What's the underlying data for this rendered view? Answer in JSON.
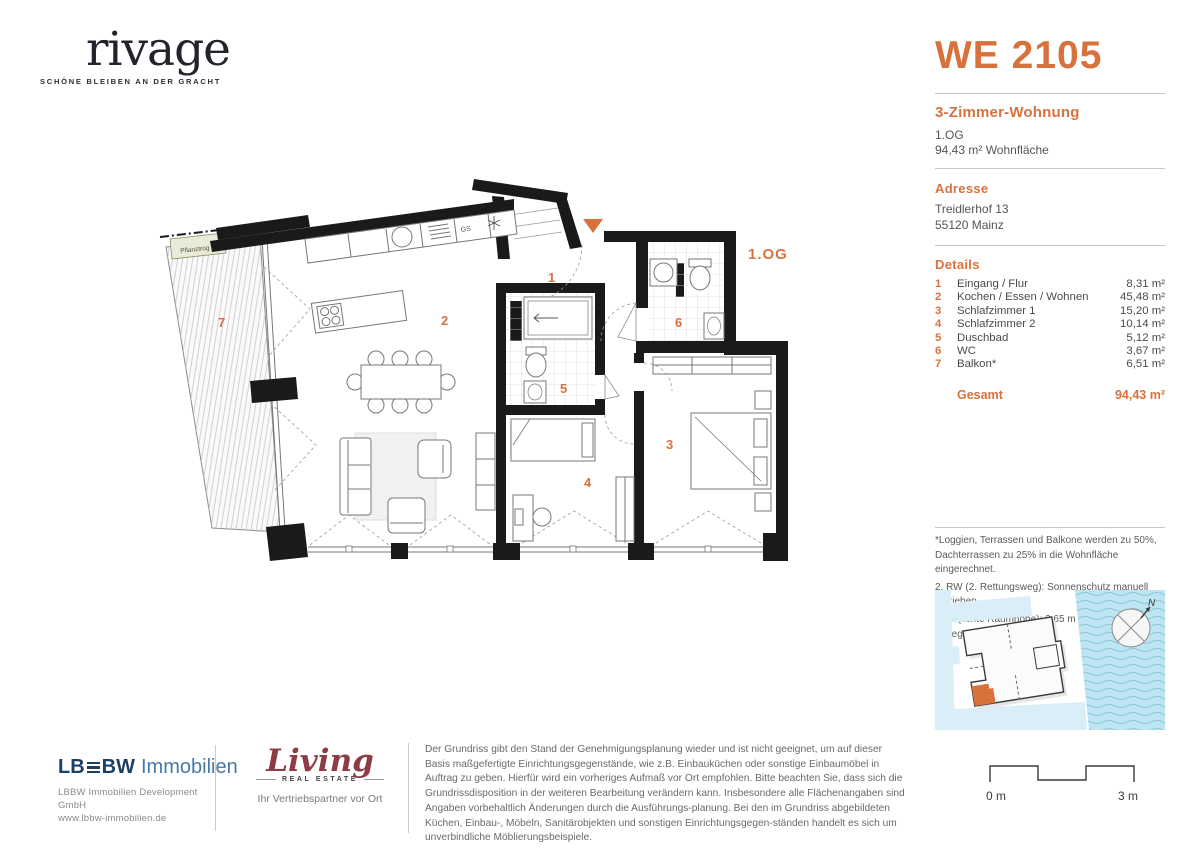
{
  "colors": {
    "accent": "#d9713c",
    "wall": "#1a1a1a",
    "lbbw_dark": "#1d3f63",
    "lbbw_light": "#4679ab",
    "living_red": "#8d3c45",
    "water": "#bfe4f1"
  },
  "brand": {
    "name": "rivage",
    "tagline": "SCHÖNE BLEIBEN AN DER GRACHT"
  },
  "unit": {
    "id": "WE 2105",
    "type": "3-Zimmer-Wohnung",
    "floor": "1.OG",
    "area_line": "94,43 m² Wohnfläche"
  },
  "address": {
    "heading": "Adresse",
    "line1": "Treidlerhof 13",
    "line2": "55120 Mainz"
  },
  "details": {
    "heading": "Details",
    "rooms": [
      {
        "num": "1",
        "name": "Eingang / Flur",
        "area": "8,31 m²"
      },
      {
        "num": "2",
        "name": "Kochen / Essen / Wohnen",
        "area": "45,48 m²"
      },
      {
        "num": "3",
        "name": "Schlafzimmer 1",
        "area": "15,20 m²"
      },
      {
        "num": "4",
        "name": "Schlafzimmer 2",
        "area": "10,14 m²"
      },
      {
        "num": "5",
        "name": "Duschbad",
        "area": "5,12 m²"
      },
      {
        "num": "6",
        "name": "WC",
        "area": "3,67 m²"
      },
      {
        "num": "7",
        "name": "Balkon*",
        "area": "6,51 m²"
      }
    ],
    "total_label": "Gesamt",
    "total_area": "94,43 m²"
  },
  "footnotes": [
    "*Loggien, Terrassen und Balkone werden zu 50%, Dachterrassen zu 25% in die Wohnfläche eingerechnet.",
    "2. RW (2. Rettungsweg): Sonnenschutz manuell betrieben",
    "LRH (lichte Raumhöhe): 2,65 m bzw. wie angegeben"
  ],
  "plan": {
    "floor_label": "1.OG",
    "planter_label": "Pflanztrog",
    "dishwasher_label": "GS",
    "room_labels": [
      "1",
      "2",
      "3",
      "4",
      "5",
      "6",
      "7"
    ]
  },
  "map": {
    "north_label": "N"
  },
  "footer": {
    "lbbw": {
      "lb": "LB",
      "bw": "BW",
      "suffix": "Immobilien",
      "line1": "LBBW Immobilien Development GmbH",
      "line2": "www.lbbw-immobilien.de"
    },
    "living": {
      "script": "Living",
      "subtitle": "REAL ESTATE",
      "tagline": "Ihr Vertriebspartner vor Ort"
    },
    "disclaimer": "Der Grundriss gibt den Stand der Genehmigungsplanung wieder und ist nicht geeignet, um auf dieser Basis maßgefertigte Einrichtungsgegenstände, wie z.B. Einbauküchen oder sonstige Einbaumöbel in Auftrag zu geben. Hierfür wird ein vorheriges Aufmaß vor Ort empfohlen. Bitte beachten Sie, dass sich die Grundrissdisposition in der weiteren Bearbeitung verändern kann. Insbesondere alle Flächenangaben sind Angaben vorbehaltlich Änderungen durch die Ausführungs-planung. Bei den im Grundriss abgebildeten Küchen, Einbau-, Möbeln, Sanitärobjekten und sonstigen Einrichtungsgegen-ständen handelt es sich um unverbindliche Möblierungsbeispiele.",
    "scale": {
      "start": "0 m",
      "end": "3 m"
    }
  }
}
